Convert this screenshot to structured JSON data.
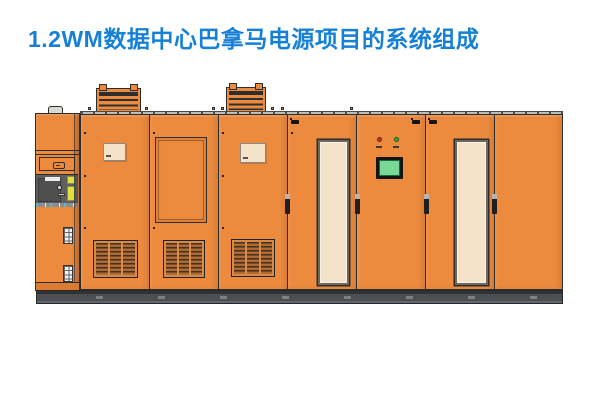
{
  "slide": {
    "title": "1.2WM数据中心巴拿马电源项目的系统组成"
  },
  "colors": {
    "title_blue": "#1580D6",
    "cabinet_orange": "#EC8A3E",
    "cabinet_orange_dark": "#DD7B30",
    "outline_dark": "#2E2E2E",
    "panel_cream": "#F4E2C9",
    "switch_panel_gray": "#5E5E5E",
    "warning_yellow": "#E2DE3B",
    "plinth_gray": "#4B4E52",
    "screen_green": "#7BD795",
    "indicator_red": "#C4392B",
    "indicator_green": "#3FA83C",
    "grille_brown": "#B06A33",
    "rim_gray": "#BDBDB8"
  },
  "illustration": {
    "description": "Front elevation drawing of an eight-cabinet power lineup on a dark plinth",
    "cabinets": [
      {
        "name": "auxiliary-switch-cabinet",
        "features": [
          "lift-handle",
          "document-slot",
          "gray-breaker-compartment",
          "yellow-warning-labels",
          "pushbutton-strips"
        ]
      },
      {
        "name": "vented-cabinet-1",
        "features": [
          "roof-vent",
          "document-pocket",
          "floor-grille"
        ]
      },
      {
        "name": "recessed-panel-cabinet",
        "features": [
          "recessed-access-panel",
          "floor-grille"
        ]
      },
      {
        "name": "vented-cabinet-2",
        "features": [
          "roof-vent",
          "document-pocket",
          "floor-grille"
        ]
      },
      {
        "name": "window-door-cabinet-1",
        "features": [
          "door-window",
          "door-handle",
          "door-latch"
        ]
      },
      {
        "name": "hmi-control-cabinet",
        "features": [
          "red-indicator",
          "green-indicator",
          "hmi-screen",
          "door-handle",
          "door-latch"
        ]
      },
      {
        "name": "window-door-cabinet-2",
        "features": [
          "door-window",
          "door-handle",
          "door-latch"
        ]
      },
      {
        "name": "plain-door-cabinet",
        "features": [
          "door-handle"
        ]
      }
    ],
    "roof_vent_count": 2,
    "floor_grille_count": 3
  }
}
